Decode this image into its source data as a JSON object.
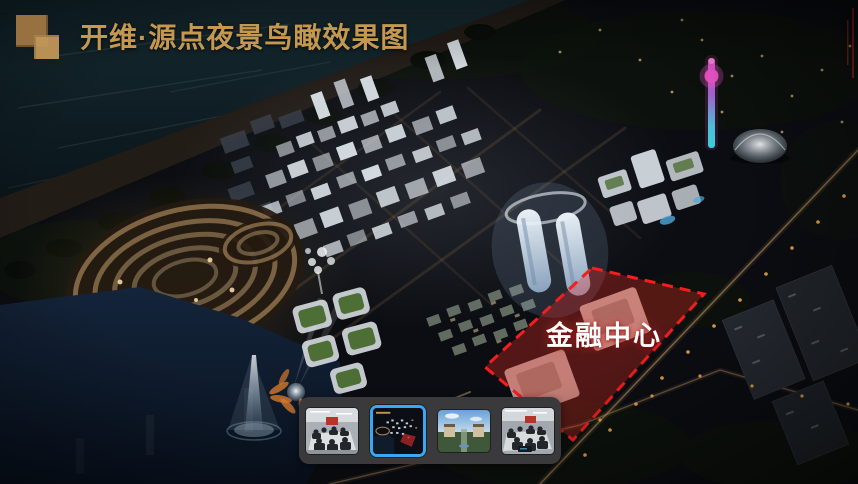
{
  "header": {
    "title": "开维·源点夜景鸟瞰效果图",
    "logo_icon": "overlapping-squares"
  },
  "annotation": {
    "zone_label": "金融中心"
  },
  "thumbnails": {
    "items": [
      {
        "name": "meeting-room-photo-1",
        "selected": false
      },
      {
        "name": "night-aerial-render-current",
        "selected": true
      },
      {
        "name": "daytime-resort-aerial",
        "selected": false
      },
      {
        "name": "meeting-room-photo-2",
        "selected": false
      }
    ]
  },
  "colors": {
    "accent-gold": "#C5984F",
    "logo-brown": "#97713F",
    "logo-tan": "#C29759",
    "zone-red": "#F31E1E",
    "zone-label": "#FFFFFF",
    "selection-blue": "#3BA6F2",
    "strip-bg": "#3A3A3C"
  }
}
